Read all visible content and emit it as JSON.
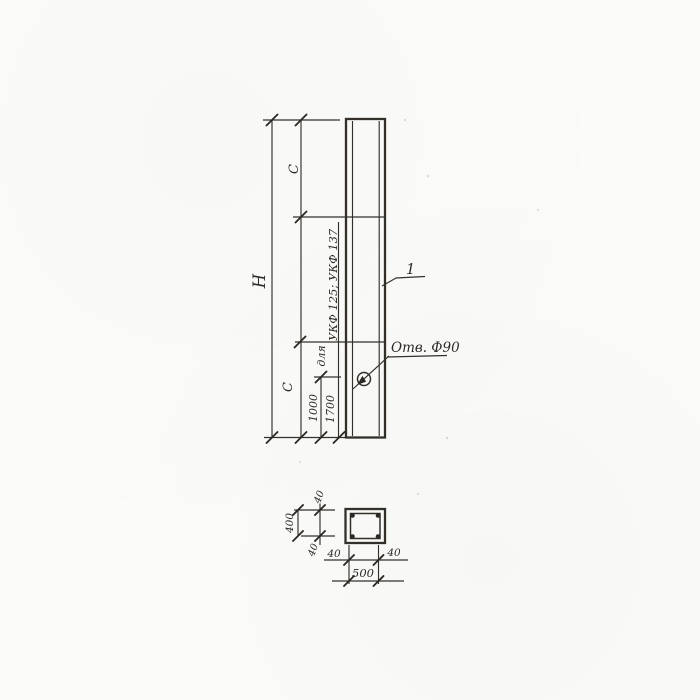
{
  "drawing": {
    "elevation": {
      "overall_height_label": "H",
      "c_upper_label": "C",
      "c_lower_label": "C",
      "hole_offset_1": "1000",
      "hole_offset_2": "1700",
      "note_prefix": "для",
      "note_models": "УКФ 125; УКФ 137",
      "hole_callout": "Отв. Ф90",
      "part_number": "1"
    },
    "section": {
      "width_label": "500",
      "height_label": "400",
      "covers": {
        "top": "40",
        "bottom": "40",
        "left": "40",
        "right": "40"
      }
    },
    "colors": {
      "ink": "#33302a",
      "paper": "#fbfbf9"
    }
  }
}
